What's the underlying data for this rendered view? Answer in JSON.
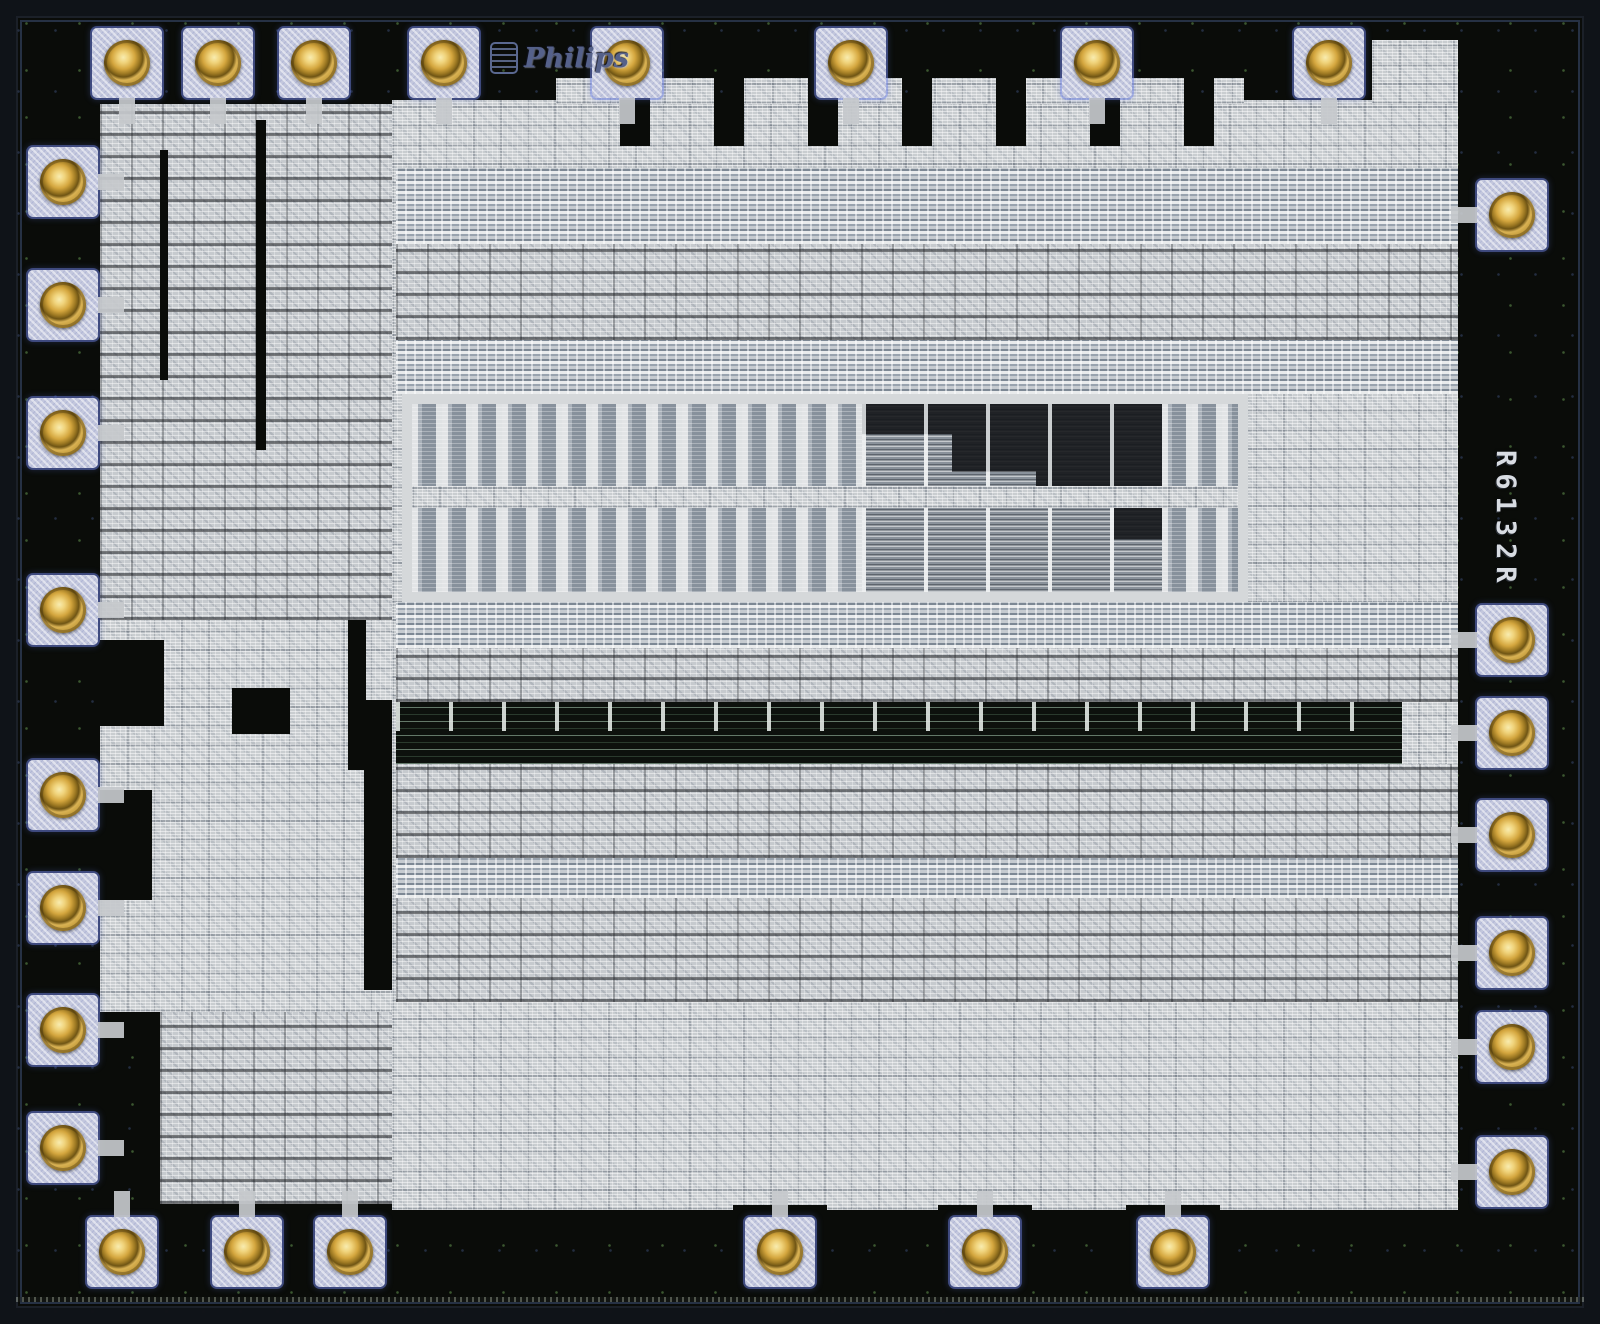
{
  "scene": {
    "description": "Microscope die photograph of a Philips integrated circuit",
    "total_bond_pads": 29
  },
  "branding": {
    "logo_text": "Philips",
    "emblem": "philips-shield-emblem"
  },
  "die_marking": {
    "part_number": "R6132R",
    "orientation": "vertical-rotated-90deg"
  },
  "colors": {
    "substrate_black": "#0a0c09",
    "metal_layer": "#c9cdd0",
    "bond_pad": "#c3c7dd",
    "gold_ball": "#d4a63e",
    "rom_panel_gray_blue": "#8a929b",
    "die_edge": "#14171d",
    "logo_blue": "#55618a",
    "marking_text": "#d8dce2"
  },
  "pads": {
    "size": 70,
    "edges": [
      {
        "edge": "top",
        "cross": 63,
        "centers": [
          127,
          218,
          314,
          444,
          627,
          851,
          1097,
          1329
        ]
      },
      {
        "edge": "left",
        "cross": 63,
        "centers": [
          182,
          305,
          433,
          610,
          795,
          908,
          1030,
          1148
        ]
      },
      {
        "edge": "right",
        "cross": 1512,
        "centers": [
          215,
          640,
          733,
          835,
          953,
          1047,
          1172
        ]
      },
      {
        "edge": "bottom",
        "cross": 1252,
        "centers": [
          122,
          247,
          350,
          780,
          985,
          1173
        ],
        "notched": [
          780,
          985,
          1173
        ]
      }
    ]
  }
}
